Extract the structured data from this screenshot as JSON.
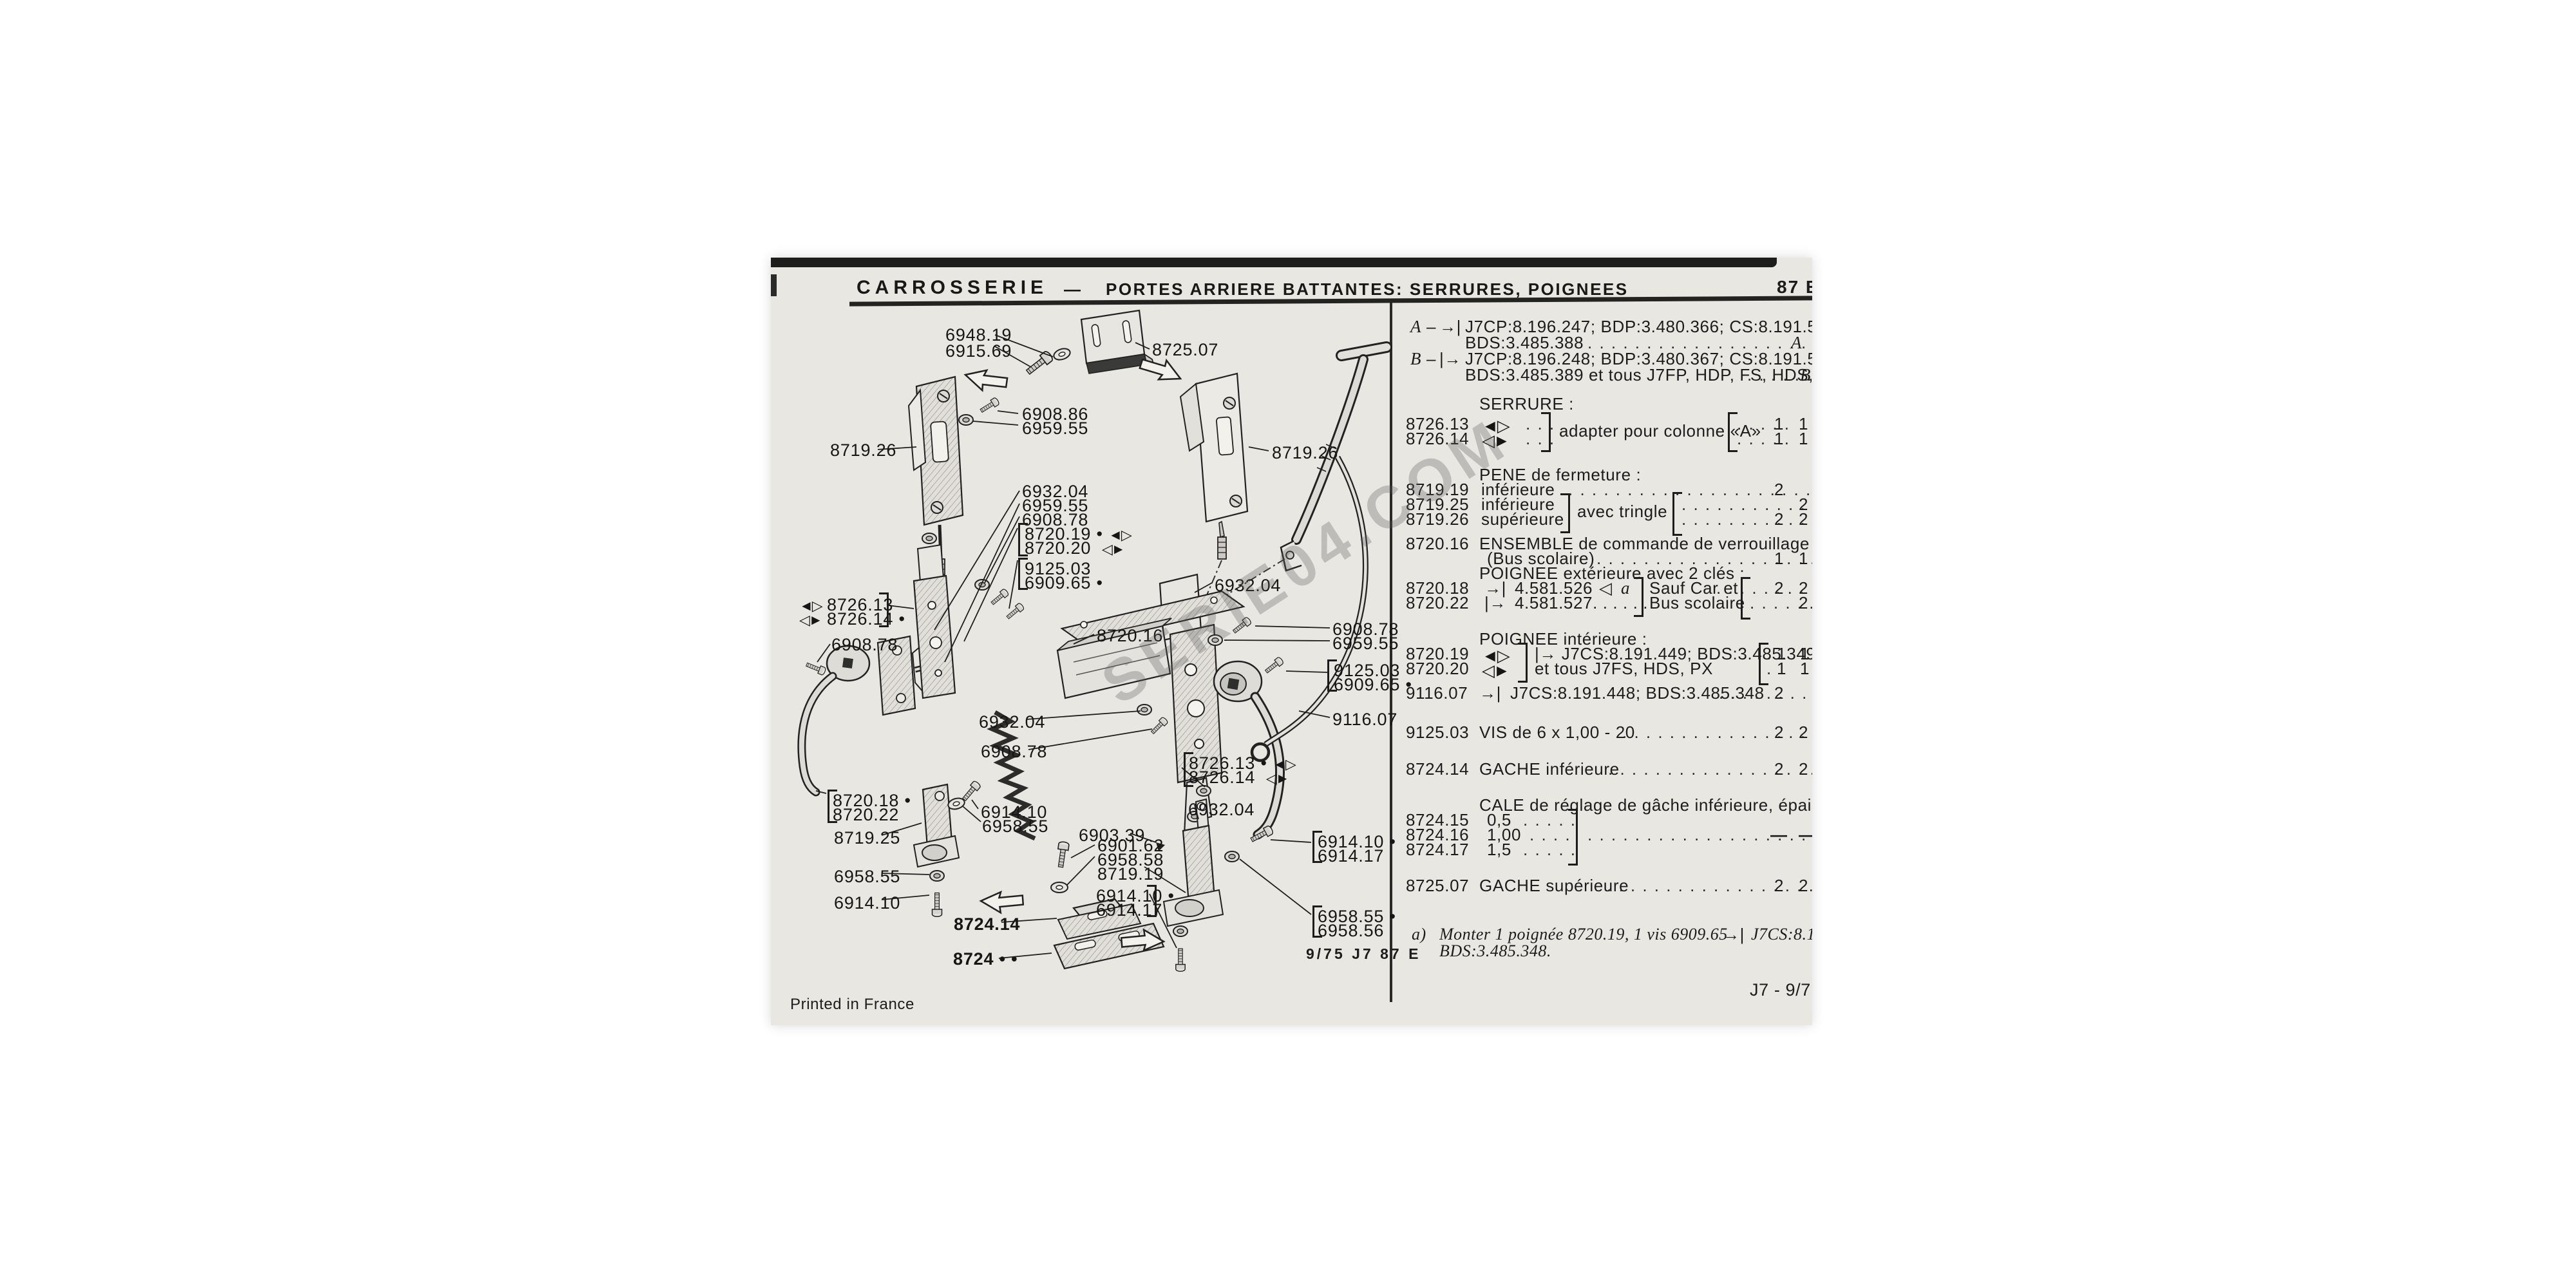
{
  "header": {
    "section": "CARROSSERIE",
    "divider": "—",
    "title": "PORTES ARRIERE BATTANTES: SERRURES, POIGNEES",
    "page_num": "87 E"
  },
  "variants": {
    "a_marker": "A",
    "a_dash": "–",
    "a_arrow": "→|",
    "a_line1": "J7CP:8.196.247; BDP:3.480.366; CS:8.191.539;",
    "a_line2": "BDS:3.485.388",
    "a_dots": ". . . . . . . . . . . . . . . . . . . . . . . . . . . . .",
    "a_end": "A",
    "b_marker": "B",
    "b_dash": "–",
    "b_arrow": "|→",
    "b_line1": "J7CP:8.196.248; BDP:3.480.367; CS:8.191.540;",
    "b_line2": "BDS:3.485.389 et tous J7FP, HDP, FS, HDS, P",
    "b_dots": ". . . . . .",
    "b_end": "B"
  },
  "list": {
    "serrure_header": "SERRURE :",
    "r8726_13": {
      "ref": "8726.13",
      "icon": "◄▷",
      "dots": ". . .",
      "qdots": ". . . . .",
      "q1": "1",
      "q2": "1"
    },
    "r8726_14": {
      "ref": "8726.14",
      "icon": "◁►",
      "dots": ". . .",
      "qdots": ". . . . .",
      "q1": "1",
      "q2": "1"
    },
    "serrure_shared": "adapter pour colonne «A»",
    "pene_header": "PENE de fermeture :",
    "r8719_19": {
      "ref": "8719.19",
      "desc": "inférieure",
      "dots": ". . . . . . . . . . . . . . . . . . . . . . . . . . . . . . . .",
      "q1": "2"
    },
    "r8719_25": {
      "ref": "8719.25",
      "desc": "inférieure",
      "qdots": ". . . . . . . . . . . . . . . . . . .",
      "q2": "2"
    },
    "r8719_26": {
      "ref": "8719.26",
      "desc": "supérieure",
      "qdots": ". . . . . . . . . . . . . . . . .",
      "q1": "2",
      "q2": "2"
    },
    "pene_shared": "avec tringle",
    "r8720_16": {
      "ref": "8720.16",
      "line1": "ENSEMBLE de commande de verrouillage",
      "line2": "(Bus scolaire)",
      "dots": ". . . . . . . . . . . . . . . . . . . . . . . . .",
      "q1": "1",
      "q2": "1"
    },
    "poignee_ext_header": "POIGNEE extérieure avec 2 clés :",
    "r8720_18": {
      "ref": "8720.18",
      "arrow": "→|",
      "num": "4.581.526",
      "tri": "◁",
      "note": "a",
      "side": "Sauf Car et",
      "qdots": ". . . . . . . .",
      "q1": "2",
      "q2": "2"
    },
    "r8720_22": {
      "ref": "8720.22",
      "arrow": "|→",
      "num": "4.581.527. . . . . .",
      "side": "Bus scolaire",
      "qdots": ". . . . . . . . . . .",
      "q1": "2"
    },
    "poignee_int_header": "POIGNEE intérieure :",
    "r8720_19": {
      "ref": "8720.19",
      "icon": "◄▷",
      "text": "|→  J7CS:8.191.449; BDS:3.485.349;",
      "qdots": ".",
      "q1": "1",
      "q2": "1"
    },
    "r8720_20": {
      "ref": "8720.20",
      "icon": "◁►",
      "text": "et tous J7FS, HDS, PX",
      "qdots": ".",
      "q1": "1",
      "q2": "1"
    },
    "r9116_07": {
      "ref": "9116.07",
      "arrow": "→|",
      "text": "J7CS:8.191.448; BDS:3.485.348",
      "dots": ". . . . . . . .",
      "q1": "2"
    },
    "r9125_03": {
      "ref": "9125.03",
      "text": "VIS de 6 x 1,00 - 20",
      "dots": ". . . . . . . . . . . . . . . . . . . . . .",
      "q1": "2",
      "q2": "2"
    },
    "r8724_14": {
      "ref": "8724.14",
      "text": "GACHE inférieure",
      "dots": ". . . . . . . . . . . . . . . . . . . . . . . .",
      "q1": "2",
      "q2": "2"
    },
    "cale_header": "CALE de réglage de gâche inférieure, épaisseur:",
    "r8724_15": {
      "ref": "8724.15",
      "val": "0,5",
      "dots": ". . . . ."
    },
    "r8724_16": {
      "ref": "8724.16",
      "val": "1,00",
      "dots": ". . . .",
      "longdots": ". . . . . . . . . . . . . . . . . . . . . . . . . . . . . .",
      "q1": "—",
      "q2": "—"
    },
    "r8724_17": {
      "ref": "8724.17",
      "val": "1,5",
      "dots": ". . . . ."
    },
    "r8725_07": {
      "ref": "8725.07",
      "text": "GACHE supérieure",
      "dots": ". . . . . . . . . . . . . . . . . . . . . . . .",
      "q1": "2",
      "q2": "2"
    },
    "note_label": "a)",
    "note_line1": "Monter 1 poignée 8720.19, 1 vis 6909.65",
    "note_arrow": "→|",
    "note_line1b": "J7CS:8.191.44",
    "note_line2": "BDS:3.485.348."
  },
  "footer": {
    "printed": "Printed in France",
    "plate": "9/75  J7   87 E",
    "doc_ref": "J7 - 9/7"
  },
  "watermark": "SERIE04.COM",
  "diagram": {
    "icons": {
      "ab": "◄▷",
      "ba": "◁►"
    },
    "labels": [
      "6948.19",
      "6915.69",
      "8725.07",
      "6908.86",
      "6959.55",
      "8719.26",
      "8719.26",
      "6932.04",
      "6959.55",
      "6908.78",
      "8720.19 •",
      "8720.20",
      "9125.03",
      "6909.65 •",
      "6932.04",
      "8726.13",
      "8726.14 •",
      "6908.78",
      "8720.16",
      "6908.78",
      "6959.55",
      "9125.03",
      "6909.65 •",
      "9116.07",
      "6932.04",
      "6908.78",
      "8726.13 •",
      "8726.14",
      "6932.04",
      "6914.10",
      "6958.55",
      "8720.18 •",
      "8720.22",
      "8719.25",
      "6958.55",
      "6914.10",
      "8724.14",
      "8724 • •",
      "6903.39",
      "6901.62",
      "6958.58",
      "8719.19",
      "6914.10 •",
      "6914.17",
      "6914.10 •",
      "6914.17",
      "6958.55 •",
      "6958.56"
    ]
  }
}
